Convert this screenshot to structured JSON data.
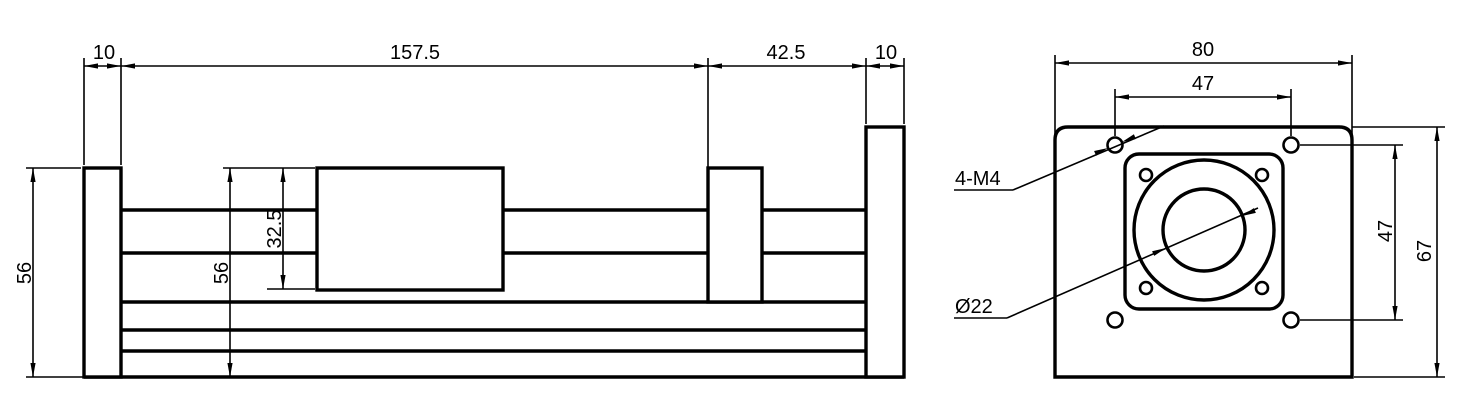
{
  "title": "Linear slide module engineering drawing, two views",
  "colors": {
    "background": "#ffffff",
    "lines": "#000000"
  },
  "side_view": {
    "dim_left_plate": "10",
    "dim_stroke_length": "157.5",
    "dim_motor_section": "42.5",
    "dim_right_plate": "10",
    "dim_overall_height": "56",
    "dim_body_height": "56",
    "dim_carriage_height": "32.5"
  },
  "end_view": {
    "dim_width": "80",
    "dim_hole_spacing_horizontal": "47",
    "dim_hole_spacing_vertical": "47",
    "dim_height": "67",
    "label_mounting_holes": "4-M4",
    "label_bore": "Ø22"
  }
}
